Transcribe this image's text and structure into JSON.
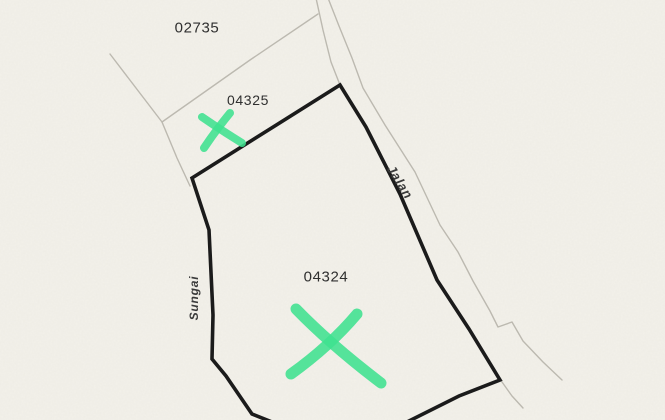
{
  "map": {
    "type": "cadastral-parcel-map",
    "background": "#f3f1ea",
    "colors": {
      "boundary": "#1b1b1b",
      "minor_line": "#bcb9b0",
      "marker_green": "#3fe190",
      "label": "#2f2f2f"
    },
    "labels": {
      "parcel_02735": {
        "text": "02735",
        "x": 197,
        "y": 28,
        "rotate": 0,
        "size": 15
      },
      "parcel_04325": {
        "text": "04325",
        "x": 248,
        "y": 100,
        "rotate": 0,
        "size": 14
      },
      "parcel_04324": {
        "text": "04324",
        "x": 326,
        "y": 277,
        "rotate": 0,
        "size": 15
      },
      "road_jalan": {
        "text": "Jalan",
        "x": 400,
        "y": 182,
        "rotate": 58,
        "size": 13
      },
      "river_sungai": {
        "text": "Sungai",
        "x": 194,
        "y": 298,
        "rotate": -90,
        "size": 12
      }
    },
    "lines": {
      "major": [
        {
          "name": "parcel-04324-boundary",
          "points": "272,422 252,414 226,376 212,359 213,315 209,230 192,178 340,85 366,127 400,194 437,280 469,329 500,380 459,396 407,422",
          "width": 3.6
        }
      ],
      "minor": [
        {
          "name": "lot-boundary-west",
          "points": "110,54 162,122 177,158 190,186",
          "width": 1.4
        },
        {
          "name": "lot-boundary-02735-04325",
          "points": "162,122 250,60 318,14",
          "width": 1.4
        },
        {
          "name": "road-edge-left-top",
          "points": "316,-2 323,30 331,62 340,85",
          "width": 1.4
        },
        {
          "name": "road-edge-right",
          "points": "328,-2 339,26 352,58 363,88 385,125 415,172 440,225 458,252 473,281 490,311 498,327 512,322 523,341 543,362 562,380",
          "width": 1.4
        },
        {
          "name": "road-edge-left-bottom",
          "points": "502,382 512,396 523,408",
          "width": 1.4
        }
      ],
      "markers": [
        {
          "name": "x-marker-04325-stroke-1",
          "d": "M202,117 Q221,130 242,143",
          "width": 8
        },
        {
          "name": "x-marker-04325-stroke-2",
          "d": "M230,113 Q216,130 204,148",
          "width": 8
        },
        {
          "name": "x-marker-04324-stroke-1",
          "d": "M296,309 Q331,345 381,383",
          "width": 11
        },
        {
          "name": "x-marker-04324-stroke-2",
          "d": "M357,314 Q330,346 291,374",
          "width": 11
        }
      ]
    }
  }
}
